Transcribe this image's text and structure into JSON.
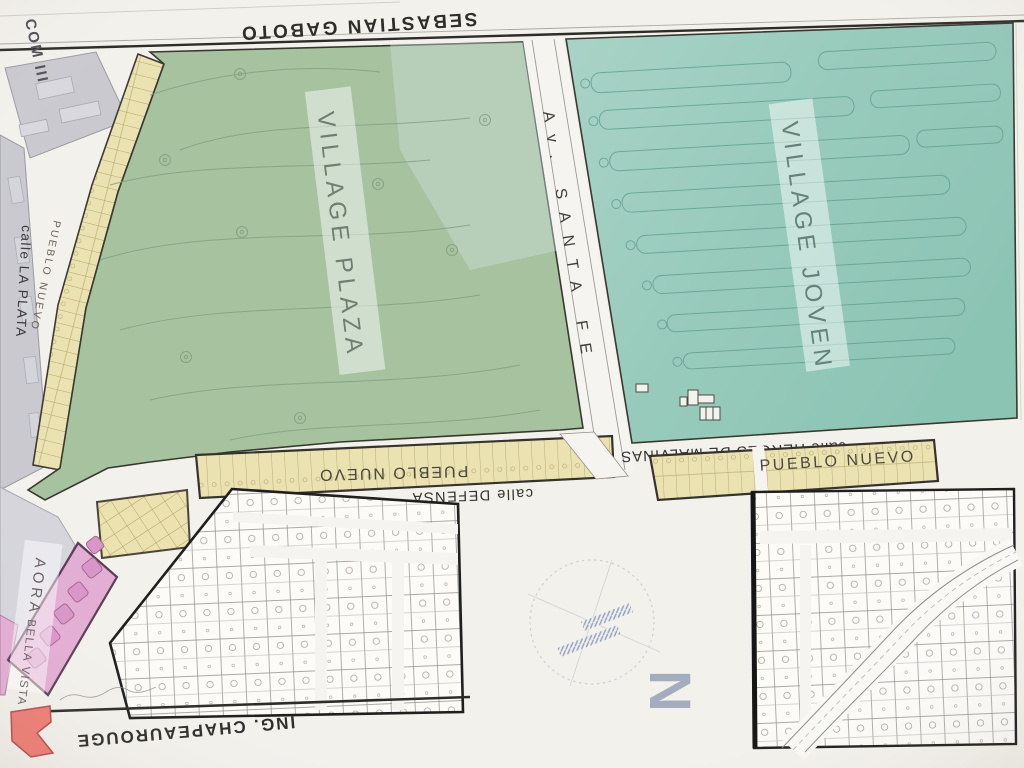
{
  "map": {
    "streets": {
      "sebastian_gaboto": "SEBASTIAN GABOTO",
      "santa_fe": "Av. SANTA FE",
      "la_plata": "calle LA PLATA",
      "defensa": "calle DEFENSA",
      "heroes_malvinas": "calle HEROES DE MALVINAS",
      "chapeaurouge": "ING. CHAPEAUROUGE"
    },
    "areas": {
      "village_plaza": "VILLAGE PLAZA",
      "village_joven": "VILLAGE JOVEN",
      "com_iii": "COM III",
      "pueblo_nuevo_left": "PUEBLO NUEVO",
      "pueblo_nuevo_center": "PUEBLO NUEVO",
      "pueblo_nuevo_right": "PUEBLO NUEVO",
      "aora": "AORA",
      "bella_vista": "BELLA VISTA"
    },
    "compass": {
      "north_label": "N"
    },
    "colors": {
      "plaza_green": "#a6c29f",
      "joven_teal": "#98cabb",
      "lot_yellow": "#ebe2b2",
      "pink_area": "#e3aed4",
      "gray_block": "#c9c9cf",
      "logo_red": "#ef7e77",
      "line_dark": "#2e2c29",
      "paper": "#f3f1ec"
    }
  }
}
